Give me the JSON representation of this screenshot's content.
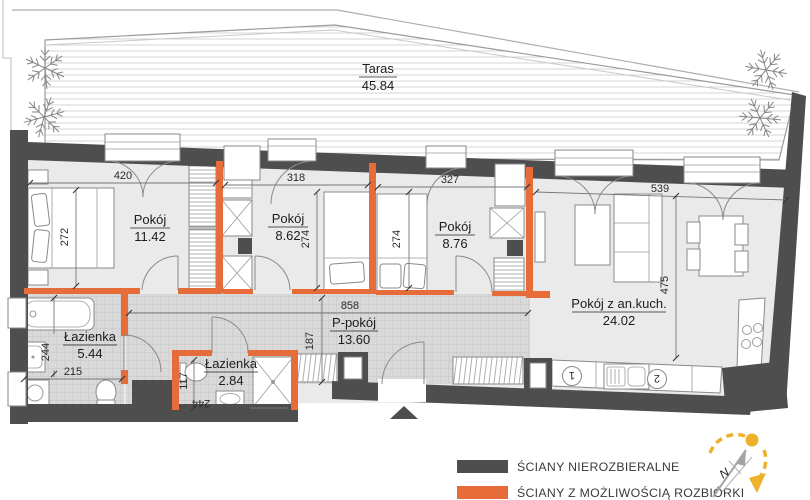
{
  "plan": {
    "terrace": {
      "name": "Taras",
      "area": "45.84"
    },
    "rooms": [
      {
        "name": "Pokój",
        "area": "11.42",
        "width": "420",
        "height": "272"
      },
      {
        "name": "Pokój",
        "area": "8.62",
        "width": "318",
        "height": "274"
      },
      {
        "name": "Pokój",
        "area": "8.76",
        "width": "327",
        "height": "274"
      },
      {
        "name": "Pokój z an.kuch.",
        "area": "24.02",
        "width": "539",
        "height": "475"
      },
      {
        "name": "P-pokój",
        "area": "13.60",
        "width": "858",
        "height": "187"
      },
      {
        "name": "Łazienka",
        "area": "5.44",
        "width": "215",
        "height": "244"
      },
      {
        "name": "Łazienka",
        "area": "2.84",
        "width": "244",
        "height": "117"
      }
    ],
    "kitchen": {
      "marker_1": "1",
      "marker_2": "2"
    }
  },
  "legend": {
    "items": [
      {
        "label": "ŚCIANY NIEROZBIERALNE",
        "color": "#4E4E4E"
      },
      {
        "label": "ŚCIANY Z MOŻLIWOŚCIĄ ROZBIÓRKI",
        "color": "#E66C3A"
      }
    ]
  },
  "compass": {
    "north": "N"
  },
  "colors": {
    "wall_fixed": "#4E4E4E",
    "wall_removable": "#E66C3A",
    "floor_room": "#EAEAEA",
    "floor_tile": "#D9D9D9",
    "accent_yellow": "#EDB12B"
  }
}
